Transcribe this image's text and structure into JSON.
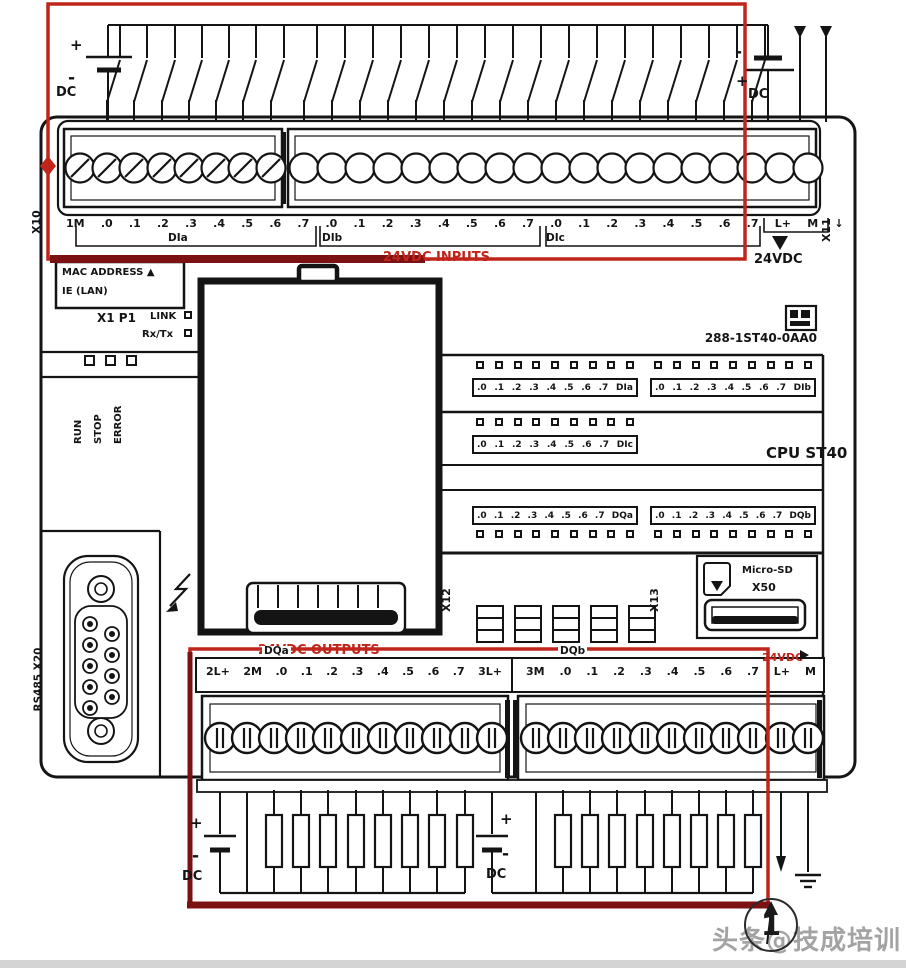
{
  "colors": {
    "accent_red": "#c0251c",
    "dark_red": "#7c1113",
    "watermark_gray": "#a3a3a3"
  },
  "battery": {
    "plus": "+",
    "minus": "-",
    "dc": "DC"
  },
  "top": {
    "x10": "X10",
    "x11": "X11",
    "terminal_labels": [
      "1M",
      ".0",
      ".1",
      ".2",
      ".3",
      ".4",
      ".5",
      ".6",
      ".7",
      ".0",
      ".1",
      ".2",
      ".3",
      ".4",
      ".5",
      ".6",
      ".7",
      ".0",
      ".1",
      ".2",
      ".3",
      ".4",
      ".5",
      ".6",
      ".7",
      "L+",
      "M",
      "↓"
    ],
    "group_dia": "DIa",
    "group_dib": "DIb",
    "group_dic": "DIc",
    "inputs_caption": "24VDC INPUTS",
    "supply_caption": "24VDC"
  },
  "panel": {
    "mac_line1": "MAC ADDRESS ▲",
    "mac_line2": "IE (LAN)",
    "port": "X1 P1",
    "link": "LINK",
    "rxtx": "Rx/Tx",
    "status_leds": [
      "RUN",
      "STOP",
      "ERROR"
    ],
    "product_code": "288-1ST40-0AA0",
    "cpu_label": "CPU ST40",
    "led_dia": [
      ".0",
      ".1",
      ".2",
      ".3",
      ".4",
      ".5",
      ".6",
      ".7",
      "DIa"
    ],
    "led_dib": [
      ".0",
      ".1",
      ".2",
      ".3",
      ".4",
      ".5",
      ".6",
      ".7",
      "DIb"
    ],
    "led_dic": [
      ".0",
      ".1",
      ".2",
      ".3",
      ".4",
      ".5",
      ".6",
      ".7",
      "DIc"
    ],
    "led_dqa": [
      ".0",
      ".1",
      ".2",
      ".3",
      ".4",
      ".5",
      ".6",
      ".7",
      "DQa"
    ],
    "led_dqb": [
      ".0",
      ".1",
      ".2",
      ".3",
      ".4",
      ".5",
      ".6",
      ".7",
      "DQb"
    ],
    "x12": "X12",
    "x13": "X13",
    "sd_line1": "Micro-SD",
    "sd_line2": "X50",
    "rs485": "RS485 X20"
  },
  "bottom": {
    "outputs_caption": "24VDC OUTPUTS",
    "labels_left": [
      "2L+",
      "2M",
      ".0",
      ".1",
      ".2",
      ".3",
      ".4",
      ".5",
      ".6",
      ".7",
      "3L+"
    ],
    "labels_right": [
      "3M",
      ".0",
      ".1",
      ".2",
      ".3",
      ".4",
      ".5",
      ".6",
      ".7",
      "L+",
      "M"
    ],
    "group_dqa": "DQa",
    "group_dqb": "DQb",
    "sensor_caption": "24VDC"
  },
  "watermark": {
    "text": "头条@技成培训",
    "callout_number": "1"
  }
}
